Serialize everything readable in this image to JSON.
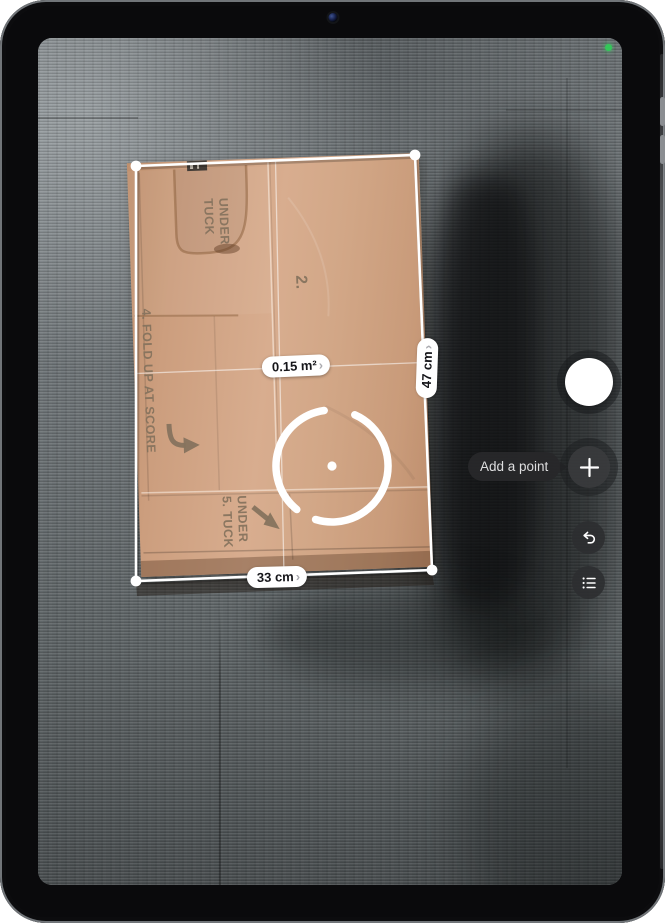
{
  "status": {
    "camera_active_color": "#34c759"
  },
  "measurement": {
    "area": {
      "label": "0.15 m²",
      "chevron": "›"
    },
    "height": {
      "label": "47 cm",
      "chevron": "›"
    },
    "width": {
      "label": "33 cm",
      "chevron": "›"
    }
  },
  "controls": {
    "tooltip": "Add a point"
  },
  "box_print": {
    "tuck_top": "TUCK UNDER",
    "panel_number": "2.",
    "step4": "4. FOLD UP AT SCORE",
    "step5": "5. TUCK UNDER"
  },
  "colors": {
    "accent_green": "#34c759",
    "cardboard": "#cda184",
    "pill_bg": "#ffffff",
    "pill_text": "#16161a",
    "tooltip_bg": "#28282a",
    "control_bg": "#38393c"
  }
}
